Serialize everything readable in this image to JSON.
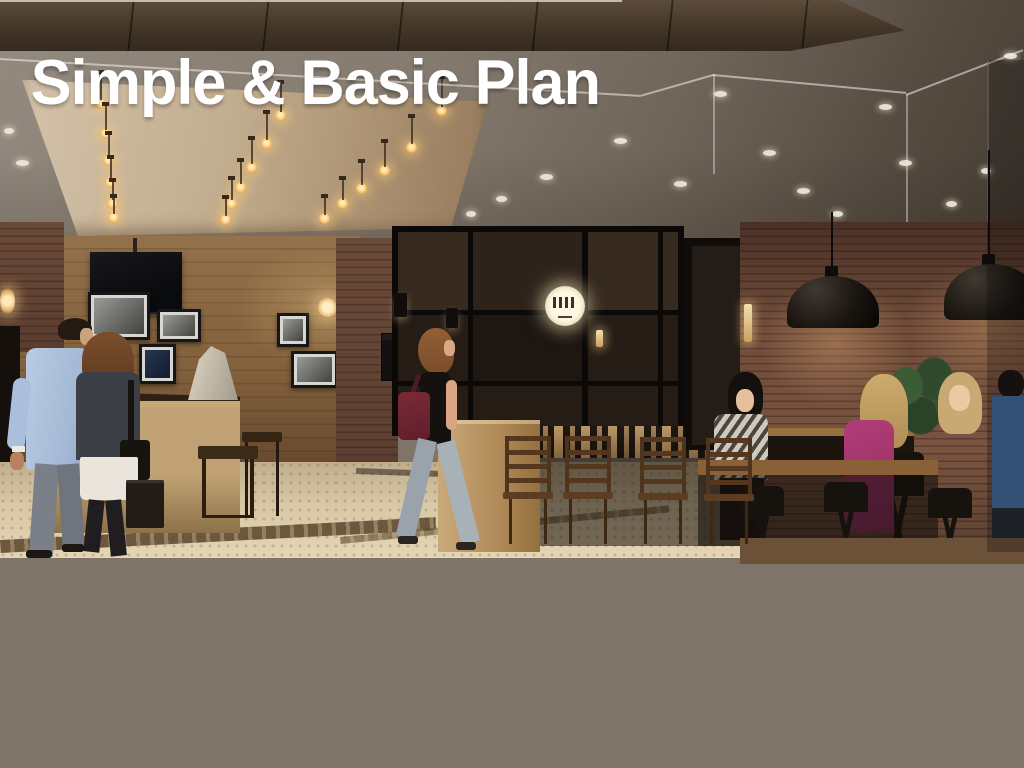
{
  "banner": {
    "title_en": "Simple & Basic Plan",
    "title_jp": "～ 朝食無料 ～",
    "bg_color": "#0E5F68",
    "text_color": "#FFFFFF"
  },
  "scene": {
    "alt": "Rendering of a hotel lobby lounge and glass-walled breakfast restaurant with Edison pendant bulbs, brick walls, framed photos, reception counter and guests walking and dining"
  }
}
